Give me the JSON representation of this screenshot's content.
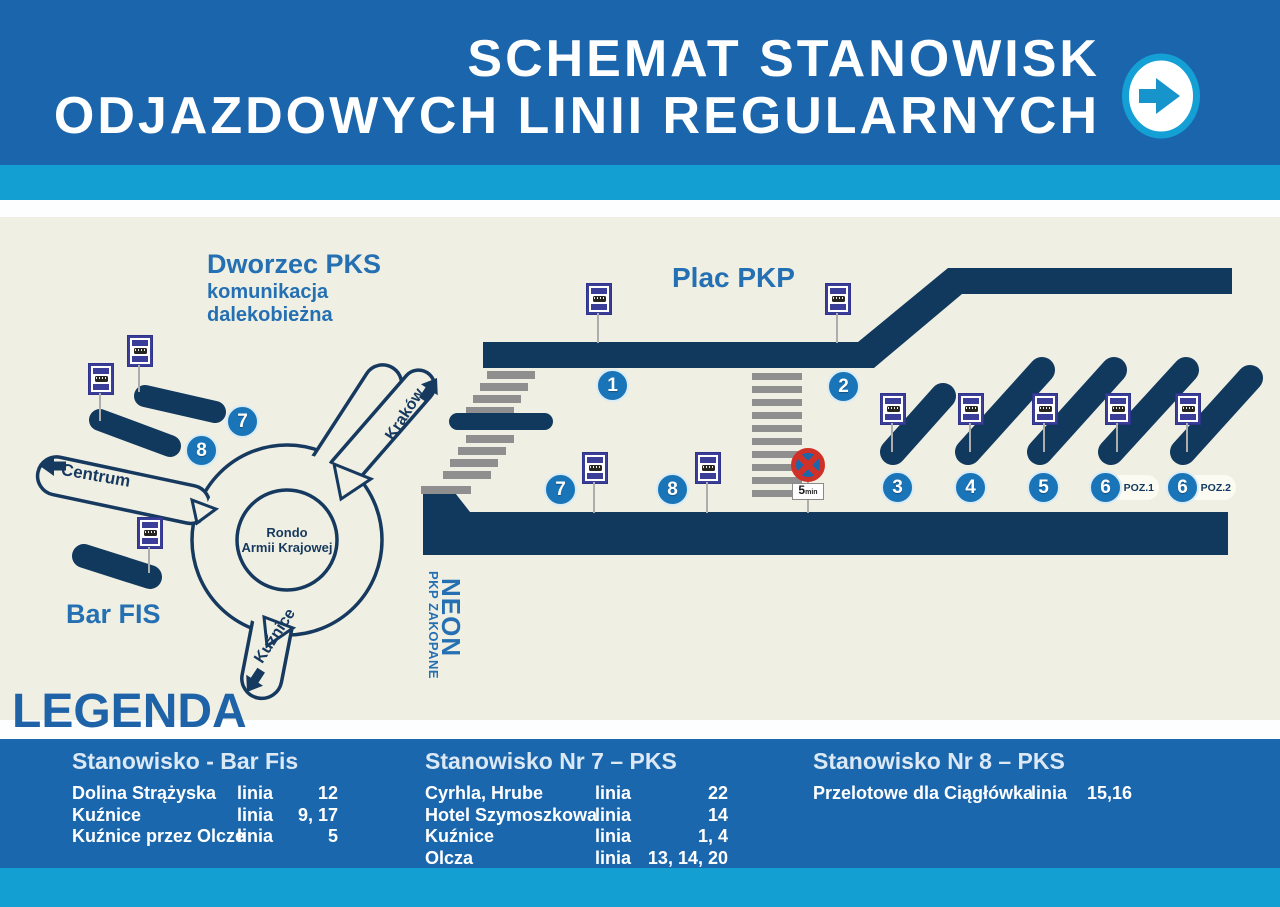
{
  "header": {
    "title_line1": "SCHEMAT STANOWISK",
    "title_line2": "ODJAZDOWYCH LINII REGULARNYCH"
  },
  "map": {
    "labels": {
      "dworzec_title": "Dworzec PKS",
      "dworzec_sub1": "komunikacja",
      "dworzec_sub2": "dalekobieżna",
      "plac_pkp": "Plac PKP",
      "bar_fis": "Bar FIS",
      "neon": "NEON",
      "pkp_zakopane": "PKP ZAKOPANE",
      "rondo_line1": "Rondo",
      "rondo_line2": "Armii Krajowej",
      "centrum": "Centrum",
      "krakow": "Kraków",
      "kuznice": "Kuźnice",
      "poz1": "POZ.1",
      "poz2": "POZ.2",
      "no_stop_time": "5",
      "no_stop_unit": "min"
    },
    "stands": {
      "s1": "1",
      "s2": "2",
      "s3": "3",
      "s4": "4",
      "s5": "5",
      "s6a": "6",
      "s6b": "6",
      "s7_dworzec": "7",
      "s8_dworzec": "8",
      "s7_pks": "7",
      "s8_pks": "8"
    }
  },
  "legend": {
    "title": "LEGENDA",
    "columns": [
      {
        "header": "Stanowisko - Bar Fis",
        "rows": [
          {
            "dest": "Dolina Strążyska",
            "label": "linia",
            "lines": "12"
          },
          {
            "dest": "Kuźnice",
            "label": "linia",
            "lines": "9, 17"
          },
          {
            "dest": "Kuźnice przez Olcze",
            "label": "linia",
            "lines": "5"
          }
        ]
      },
      {
        "header": "Stanowisko Nr 7 – PKS",
        "rows": [
          {
            "dest": "Cyrhla, Hrube",
            "label": "linia",
            "lines": "22"
          },
          {
            "dest": "Hotel Szymoszkowa",
            "label": "linia",
            "lines": "14"
          },
          {
            "dest": "Kuźnice",
            "label": "linia",
            "lines": "1, 4"
          },
          {
            "dest": "Olcza",
            "label": "linia",
            "lines": "13, 14, 20"
          }
        ]
      },
      {
        "header": "Stanowisko Nr 8 – PKS",
        "rows": [
          {
            "dest": "Przelotowe dla Ciągłówka",
            "label": "linia",
            "lines": "15,16"
          }
        ]
      }
    ]
  },
  "colors": {
    "header_blue": "#1a65ac",
    "cyan": "#149fd3",
    "cream": "#f0efe3",
    "navy": "#11395e",
    "circle_blue": "#1a74b8",
    "sign_indigo": "#3b3e99",
    "legend_blue": "#1b67ad",
    "accent_text_blue": "#2470b3",
    "no_stop_red": "#cf3128"
  }
}
